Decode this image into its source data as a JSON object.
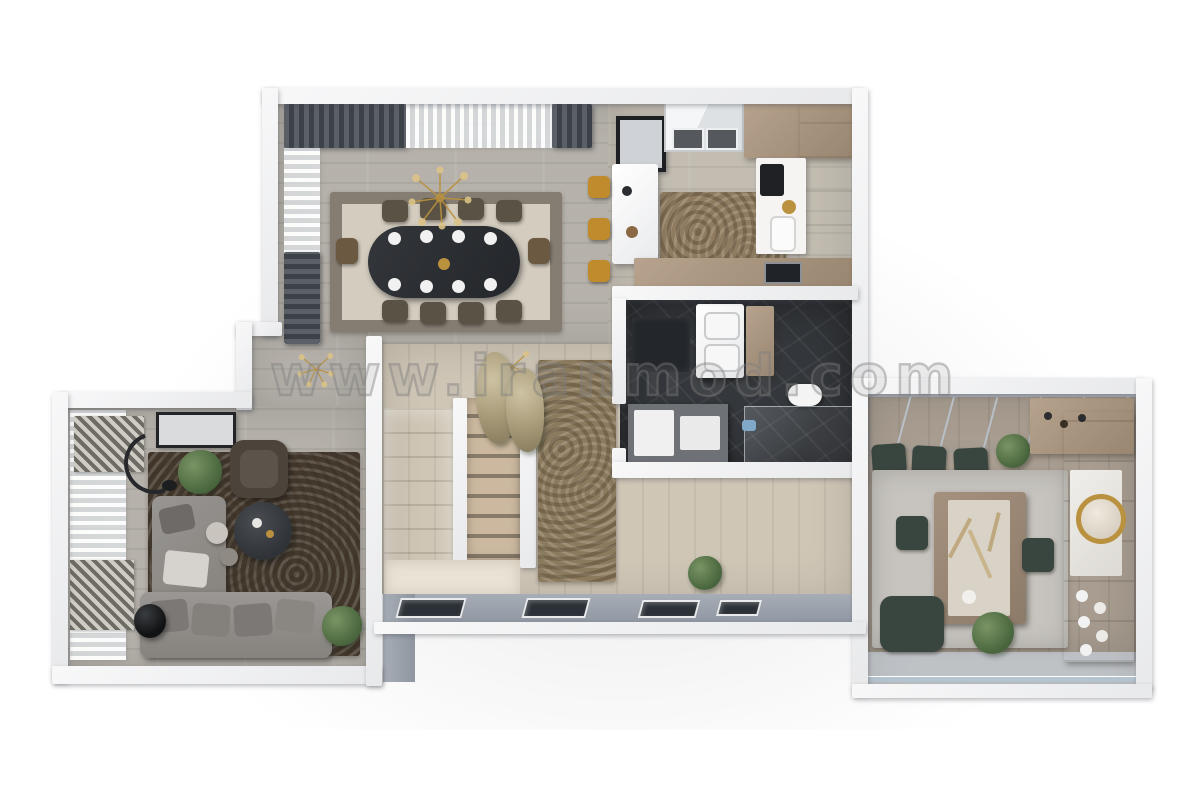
{
  "scene": {
    "type": "3d-floor-plan-top-view-render",
    "background_color": "#ffffff",
    "watermark": {
      "text": "www.iranmod.com"
    }
  },
  "palette": {
    "wall": "#f2f3f4",
    "wall_shadow": "#d7d9dc",
    "exterior_wall": "#9aa1ab",
    "wood_floor_gray": "#b6b2ab",
    "wood_floor_light": "#cfc6b6",
    "wood_cabinet": "#ab977f",
    "dark_marble": "#34373b",
    "sofa_gray": "#8f8c89",
    "rug_dark_brown": "#43392f",
    "rug_beige": "#d3ccbf",
    "rug_mottled_brown": "#8a7a5e",
    "rug_light_gray": "#c7c4bf",
    "stool_mustard": "#c08b2d",
    "chair_olive": "#5a5244",
    "chair_green": "#39453f",
    "gold_accent": "#b9913f",
    "plant_green": "#4e6b42"
  },
  "rooms": [
    {
      "id": "dining-room",
      "name": "Dining room",
      "items": [
        "oval dining table",
        "8 place settings",
        "8 olive dining chairs",
        "2 end chairs",
        "gold sputnik chandelier",
        "bordered beige rug",
        "dark drapes",
        "sheer curtains"
      ]
    },
    {
      "id": "kitchen",
      "name": "Kitchen",
      "items": [
        "white island counter",
        "3 mustard bar stools",
        "framed wall art",
        "window",
        "tall wood cabinets",
        "coffee station",
        "sink",
        "built-in oven",
        "mottled rug",
        "base cabinet run"
      ]
    },
    {
      "id": "bathroom",
      "name": "Bathroom",
      "items": [
        "double white vanity",
        "wood shelf",
        "dark bench",
        "toilet",
        "drawer unit",
        "glass shower screen"
      ]
    },
    {
      "id": "stair-hall",
      "name": "Hall and staircase",
      "items": [
        "down flight",
        "tread flight",
        "divider walls",
        "mottled runner rug",
        "dried plants",
        "gold pendant lights",
        "window wall"
      ]
    },
    {
      "id": "lounge",
      "name": "Lounge",
      "items": [
        "gray corner sofa",
        "seat cushions",
        "round coffee table",
        "side tables",
        "dark armchair",
        "arc floor lamp",
        "framed art",
        "sheer window curtains",
        "slat blinds",
        "dark brown rug",
        "black vase",
        "plants"
      ]
    },
    {
      "id": "family-room",
      "name": "Family dining room",
      "items": [
        "panoramic window wall",
        "3 green window chairs",
        "table with decorated runner",
        "2 green side chairs",
        "green armchair",
        "wall unit with round gold mirror",
        "display shelves with plates",
        "sideboard with bottles",
        "light gray rug",
        "plants"
      ]
    },
    {
      "id": "terrace",
      "name": "Terrace",
      "items": [
        "glass railing"
      ]
    }
  ]
}
